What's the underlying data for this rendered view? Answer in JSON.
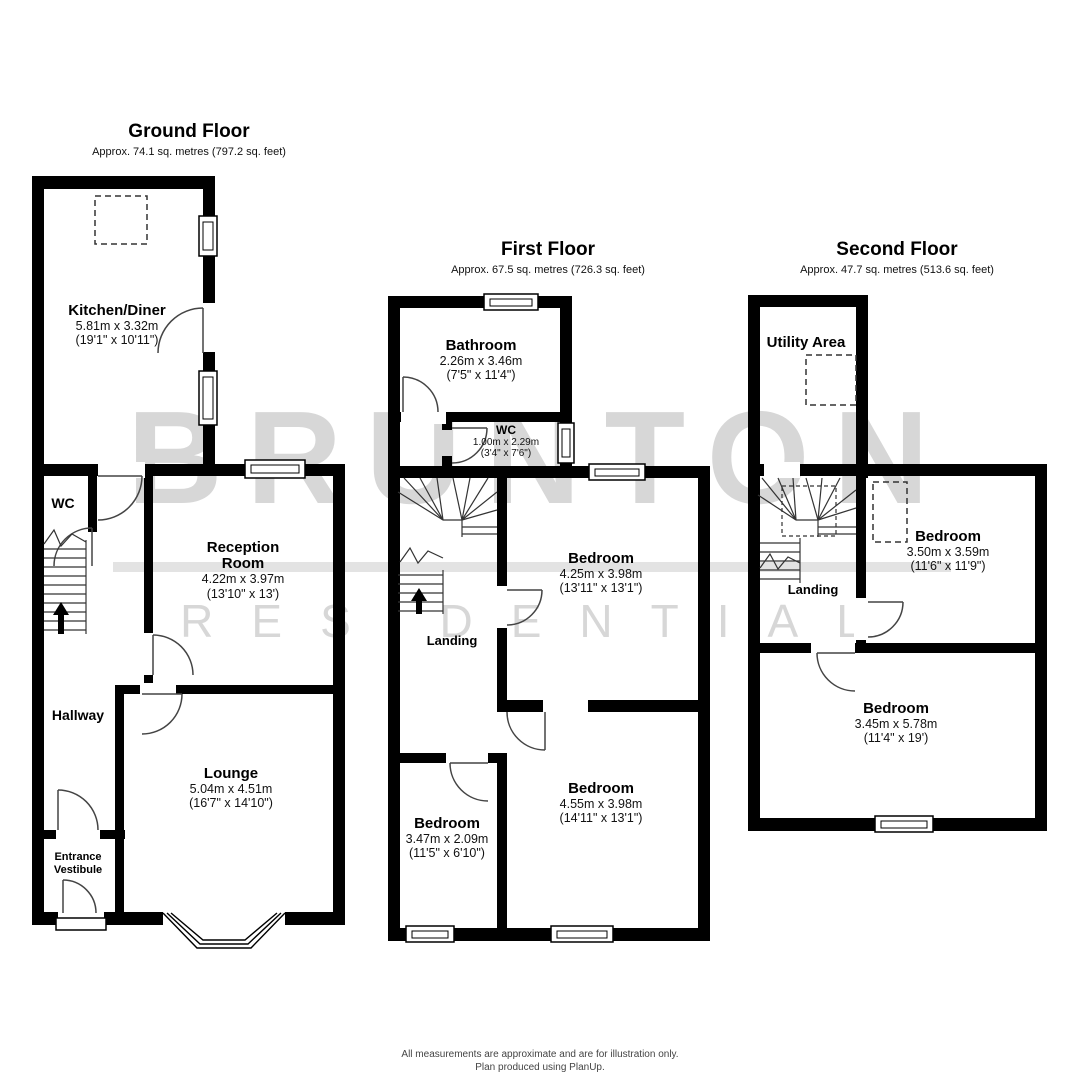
{
  "watermark": {
    "line1": "BRUNTON",
    "line2": "RESIDENTIAL",
    "text_color": "#d7d7d7",
    "bar_color": "#e3e3e3"
  },
  "floors": {
    "ground": {
      "title": "Ground Floor",
      "subtitle": "Approx. 74.1 sq. metres (797.2 sq. feet)",
      "rooms": {
        "kitchen": {
          "name": "Kitchen/Diner",
          "metric": "5.81m x 3.32m",
          "imperial": "(19'1\" x 10'11\")"
        },
        "wc": {
          "name": "WC"
        },
        "reception": {
          "name": "Reception Room",
          "metric": "4.22m x 3.97m",
          "imperial": "(13'10\" x 13')"
        },
        "hallway": {
          "name": "Hallway"
        },
        "lounge": {
          "name": "Lounge",
          "metric": "5.04m x 4.51m",
          "imperial": "(16'7\" x 14'10\")"
        },
        "vestibule": {
          "name": "Entrance Vestibule"
        }
      }
    },
    "first": {
      "title": "First Floor",
      "subtitle": "Approx. 67.5 sq. metres (726.3 sq. feet)",
      "rooms": {
        "bathroom": {
          "name": "Bathroom",
          "metric": "2.26m x 3.46m",
          "imperial": "(7'5\" x 11'4\")"
        },
        "wc": {
          "name": "WC",
          "metric": "1.00m x 2.29m",
          "imperial": "(3'4\" x 7'6\")"
        },
        "bedroom_mid": {
          "name": "Bedroom",
          "metric": "4.25m x 3.98m",
          "imperial": "(13'11\" x 13'1\")"
        },
        "landing": {
          "name": "Landing"
        },
        "bedroom_left": {
          "name": "Bedroom",
          "metric": "3.47m x 2.09m",
          "imperial": "(11'5\" x 6'10\")"
        },
        "bedroom_rear": {
          "name": "Bedroom",
          "metric": "4.55m x 3.98m",
          "imperial": "(14'11\" x 13'1\")"
        }
      }
    },
    "second": {
      "title": "Second Floor",
      "subtitle": "Approx. 47.7 sq. metres (513.6 sq. feet)",
      "rooms": {
        "utility": {
          "name": "Utility Area"
        },
        "bedroom_front": {
          "name": "Bedroom",
          "metric": "3.50m x 3.59m",
          "imperial": "(11'6\" x 11'9\")"
        },
        "landing": {
          "name": "Landing"
        },
        "bedroom_rear": {
          "name": "Bedroom",
          "metric": "3.45m x 5.78m",
          "imperial": "(11'4\" x 19')"
        }
      }
    }
  },
  "footer": {
    "line1": "All measurements are approximate and are for illustration only.",
    "line2": "Plan produced using PlanUp."
  }
}
